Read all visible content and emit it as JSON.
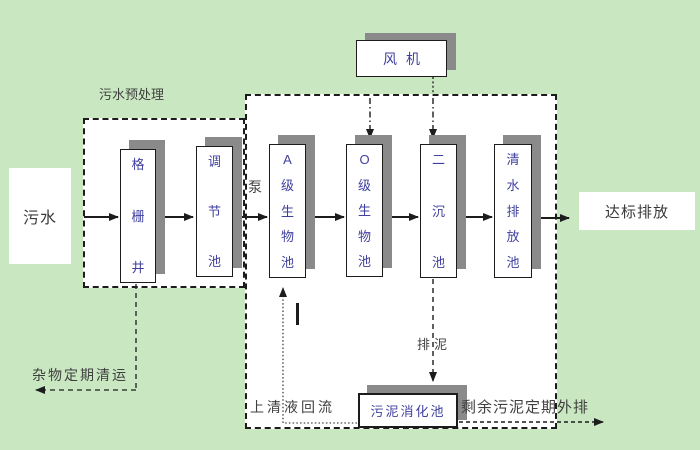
{
  "colors": {
    "background": "#c9e7c1",
    "panel": "#ffffff",
    "line": "#1c1c1c",
    "shadow": "#8a8a8a",
    "tank_text": "#4040a0",
    "label_text": "#3f3f3f"
  },
  "nodes": {
    "influent": {
      "label": "污水"
    },
    "pretreatment": {
      "label": "污水预处理"
    },
    "grid_well": {
      "label": "格栅井"
    },
    "regulating_tank": {
      "label": "调节池"
    },
    "pump": {
      "label": "泵"
    },
    "tank_a": {
      "label": "A级生物池"
    },
    "tank_o": {
      "label": "O级生物池"
    },
    "secondary_clarifier": {
      "label": "二沉池"
    },
    "clear_water_tank": {
      "label": "清水排放池"
    },
    "blower": {
      "label": "风机"
    },
    "sludge_digester": {
      "label": "污泥消化池"
    },
    "discharge": {
      "label": "达标排放"
    }
  },
  "flow_labels": {
    "debris_removal": "杂物定期清运",
    "supernatant_return": "上清液回流",
    "sludge_drain": "排泥",
    "excess_sludge_out": "剩余污泥定期外排"
  }
}
